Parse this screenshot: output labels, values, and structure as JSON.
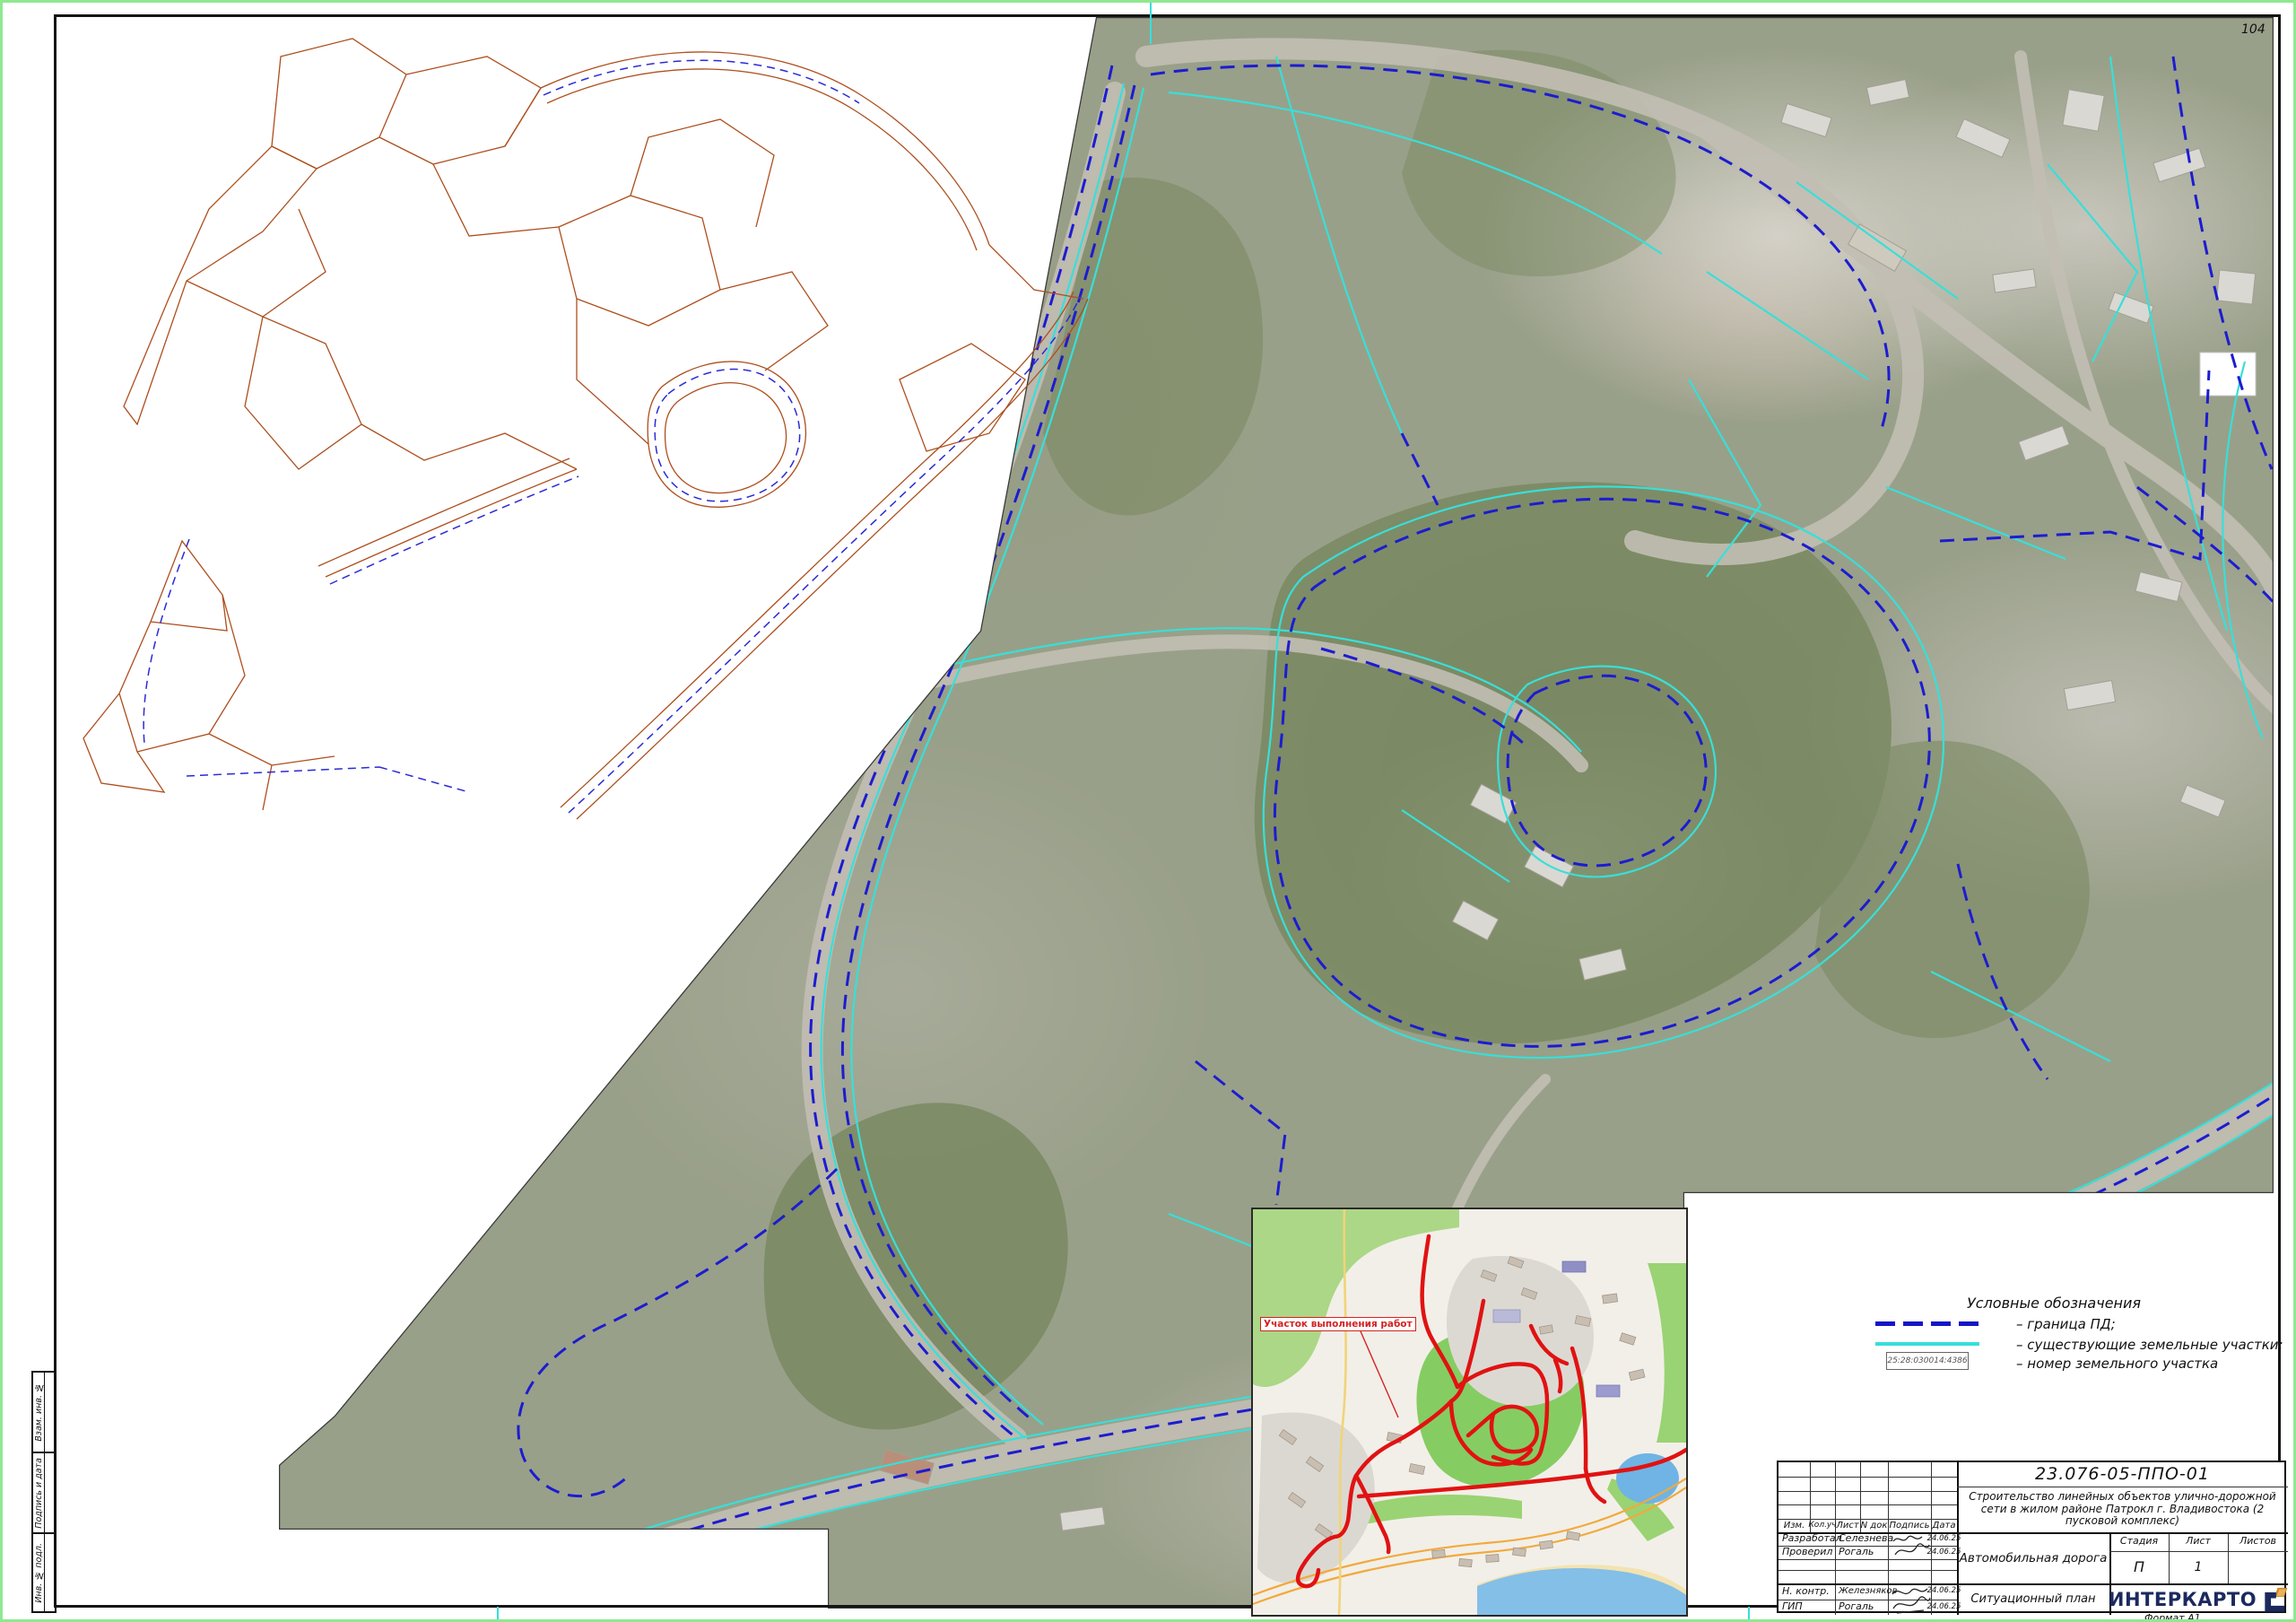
{
  "page": {
    "sheet_number": "104",
    "format_label": "Формат А1"
  },
  "margin": {
    "labels": [
      "Взам. инв. №",
      "Подпись и дата",
      "Инв. № подл."
    ]
  },
  "legend": {
    "title": "Условные обозначения",
    "items": [
      {
        "swatch": "dashed-blue-line",
        "label": "– граница ПД;"
      },
      {
        "swatch": "solid-cyan-line",
        "label": "– существующие земельные участки;"
      },
      {
        "swatch": "parcel-number-box",
        "box_text": "25:28:030014:4386",
        "label": "– номер земельного участка"
      }
    ]
  },
  "inset": {
    "label": "Участок выполнения работ"
  },
  "stamp": {
    "doc_number": "23.076-05-ППО-01",
    "project": "Строительство линейных объектов улично-дорожной сети в жилом районе Патрокл г. Владивостока (2 пусковой комплекс)",
    "object_title": "Автомобильная дорога",
    "sheet_title": "Ситуационный план",
    "headers": {
      "izm": "Изм.",
      "koluch": "Кол.уч",
      "list": "Лист",
      "ndok": "N док",
      "podpis": "Подпись",
      "data": "Дата"
    },
    "stage_label": "Стадия",
    "stage_value": "П",
    "list_label": "Лист",
    "list_value": "1",
    "listov_label": "Листов",
    "listov_value": "",
    "rows": [
      {
        "role": "Разработал",
        "name": "Селезнева",
        "date": "24.06.25"
      },
      {
        "role": "Проверил",
        "name": "Рогаль",
        "date": "24.06.25"
      },
      {
        "role": "Н. контр.",
        "name": "Железняков",
        "date": "24.06.25"
      },
      {
        "role": "ГИП",
        "name": "Рогаль",
        "date": "24.06.25"
      }
    ],
    "logo_text": "ИНТЕРКАРТО"
  },
  "colors": {
    "boundary_blue": "#1c1cd0",
    "cadastral_cyan": "#38dfd9",
    "route_red": "#e11212",
    "cad_brown": "#ad4e1d",
    "page_border_green": "#8fe98f",
    "logo_navy": "#1b2a5e",
    "logo_gold": "#c9872b"
  }
}
